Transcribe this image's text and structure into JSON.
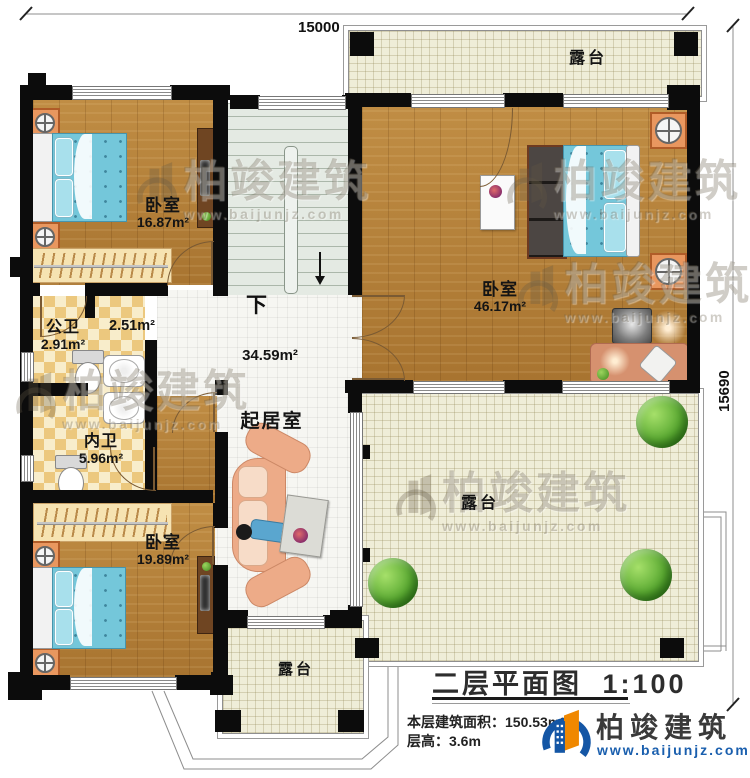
{
  "title_block": {
    "title": "二层平面图",
    "scale": "1:100",
    "area_label": "本层建筑面积：",
    "area_value": "150.53m²",
    "height_label": "层高：",
    "height_value": "3.6m"
  },
  "brand": {
    "name": "柏竣建筑",
    "website": "www.baijunjz.com"
  },
  "dimensions": {
    "top": "15000",
    "right": "15690"
  },
  "rooms": {
    "bedroom_top_left": {
      "name": "卧室",
      "area": "16.87m²"
    },
    "master_bedroom": {
      "name": "卧室",
      "area": "46.17m²"
    },
    "bedroom_bottom_left": {
      "name": "卧室",
      "area": "19.89m²"
    },
    "public_bathroom": {
      "name": "公卫",
      "area": "2.91m²"
    },
    "wash_area": {
      "area": "2.51m²"
    },
    "private_bathroom": {
      "name": "内卫",
      "area": "5.96m²"
    },
    "living_room": {
      "name": "起居室",
      "area": "34.59m²"
    },
    "terrace_top": {
      "name": "露台"
    },
    "terrace_right": {
      "name": "露台"
    },
    "terrace_bottom": {
      "name": "露台"
    },
    "stairs": {
      "direction_label": "下"
    }
  }
}
